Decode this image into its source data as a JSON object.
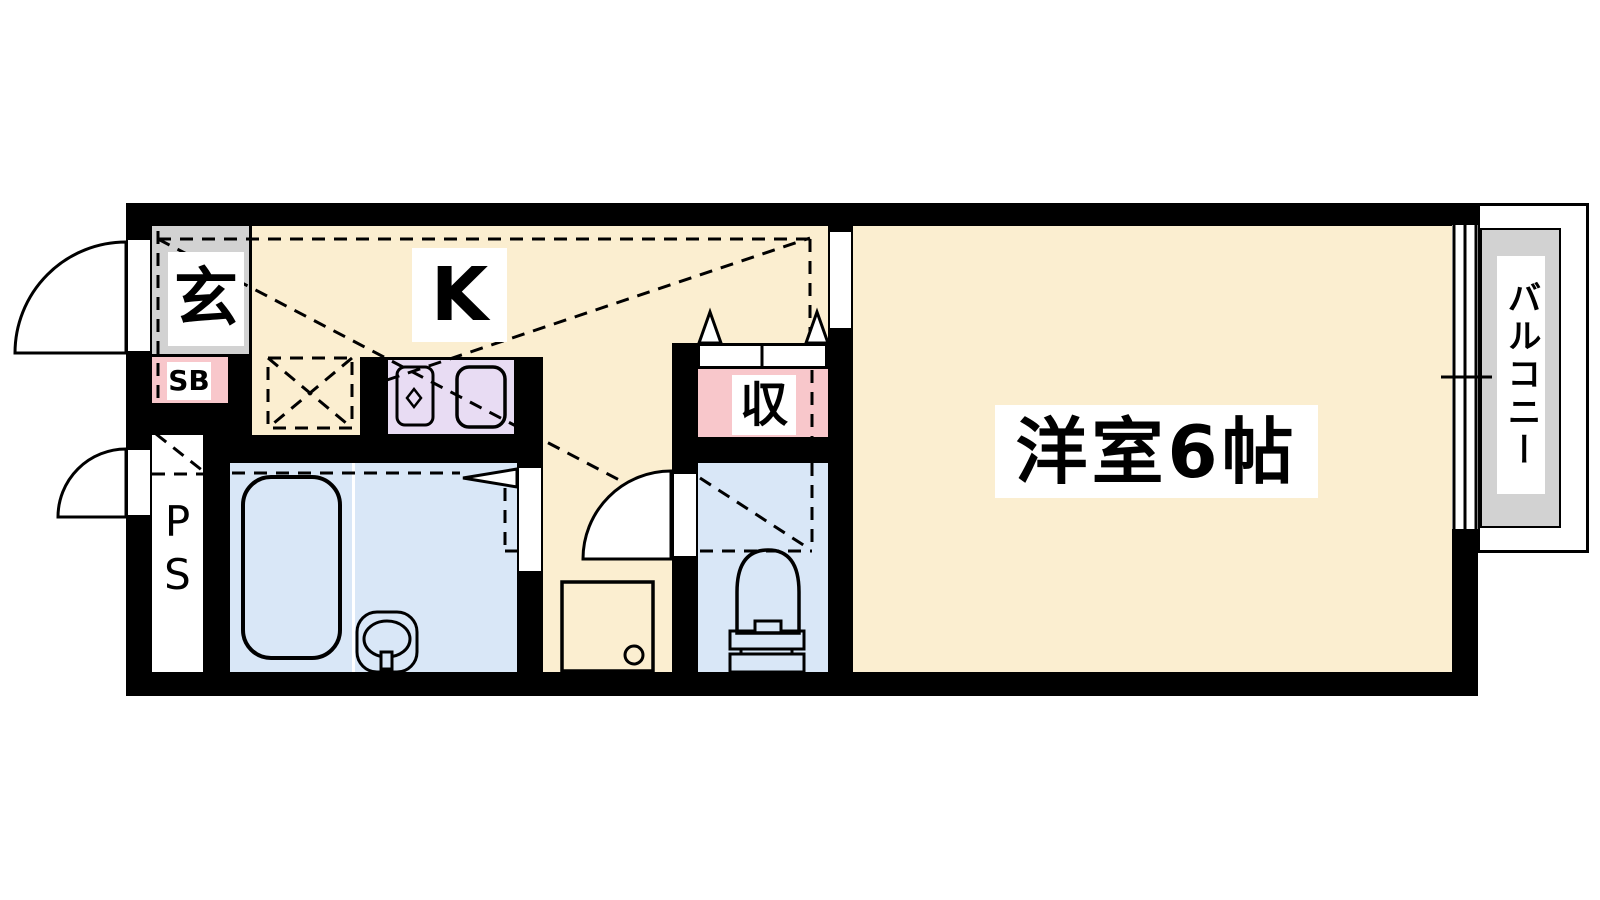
{
  "floorplan": {
    "labels": {
      "genkan": "玄",
      "shoe_box": "SB",
      "kitchen": "K",
      "closet": "収",
      "western_room": "洋室6帖",
      "balcony": "バルコニー",
      "pipe_space": "PS"
    },
    "colors": {
      "wall": "#000000",
      "floor_cream": "#FBEED0",
      "wet_blue": "#D9E7F7",
      "counter_purple": "#E8DCF3",
      "storage_pink": "#F8C7CB",
      "entrance_gray": "#D2D2D2",
      "background": "#FFFFFF"
    }
  }
}
